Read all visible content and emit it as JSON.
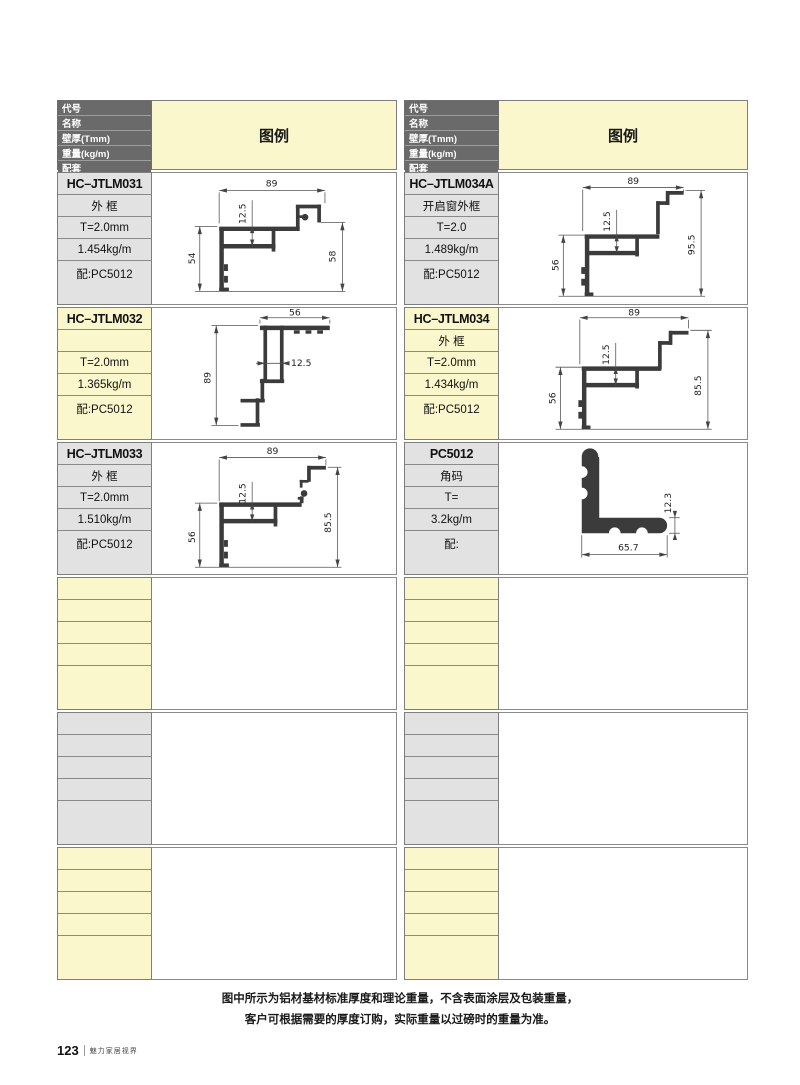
{
  "colors": {
    "header_bg": "#6a6a6a",
    "row_yellow": "#fbf7cc",
    "row_gray": "#e2e2e2"
  },
  "header": {
    "field_labels": [
      "代号",
      "名称",
      "壁厚(Tmm)",
      "重量(kg/m)",
      "配套"
    ],
    "legend_label": "图例"
  },
  "columns": [
    {
      "entries": [
        {
          "code": "HC–JTLM031",
          "name": "外 框",
          "thickness": "T=2.0mm",
          "weight": "1.454kg/m",
          "match": "配:PC5012",
          "dims": {
            "width": "89",
            "inner": "12.5",
            "left": "54",
            "right": "58"
          }
        },
        {
          "code": "HC–JTLM032",
          "name": "",
          "thickness": "T=2.0mm",
          "weight": "1.365kg/m",
          "match": "配:PC5012",
          "dims": {
            "width": "56",
            "inner": "12.5",
            "left": "89"
          }
        },
        {
          "code": "HC–JTLM033",
          "name": "外 框",
          "thickness": "T=2.0mm",
          "weight": "1.510kg/m",
          "match": "配:PC5012",
          "dims": {
            "width": "89",
            "inner": "12.5",
            "left": "56",
            "right": "85.5"
          }
        }
      ]
    },
    {
      "entries": [
        {
          "code": "HC–JTLM034A",
          "name": "开启窗外框",
          "thickness": "T=2.0",
          "weight": "1.489kg/m",
          "match": "配:PC5012",
          "dims": {
            "width": "89",
            "inner": "12.5",
            "left": "56",
            "right": "95.5"
          }
        },
        {
          "code": "HC–JTLM034",
          "name": "外 框",
          "thickness": "T=2.0mm",
          "weight": "1.434kg/m",
          "match": "配:PC5012",
          "dims": {
            "width": "89",
            "inner": "12.5",
            "left": "56",
            "right": "85.5"
          }
        },
        {
          "code": "PC5012",
          "name": "角码",
          "thickness": "T=",
          "weight": "3.2kg/m",
          "match": "配:",
          "dims": {
            "bottom": "65.7",
            "right": "12.3"
          }
        }
      ]
    }
  ],
  "footer": {
    "note_line1": "图中所示为铝材基材标准厚度和理论重量，不含表面涂层及包装重量，",
    "note_line2": "客户可根据需要的厚度订购，实际重量以过磅时的重量为准。",
    "page_number": "123",
    "brand_text": "魅力家居视界"
  }
}
